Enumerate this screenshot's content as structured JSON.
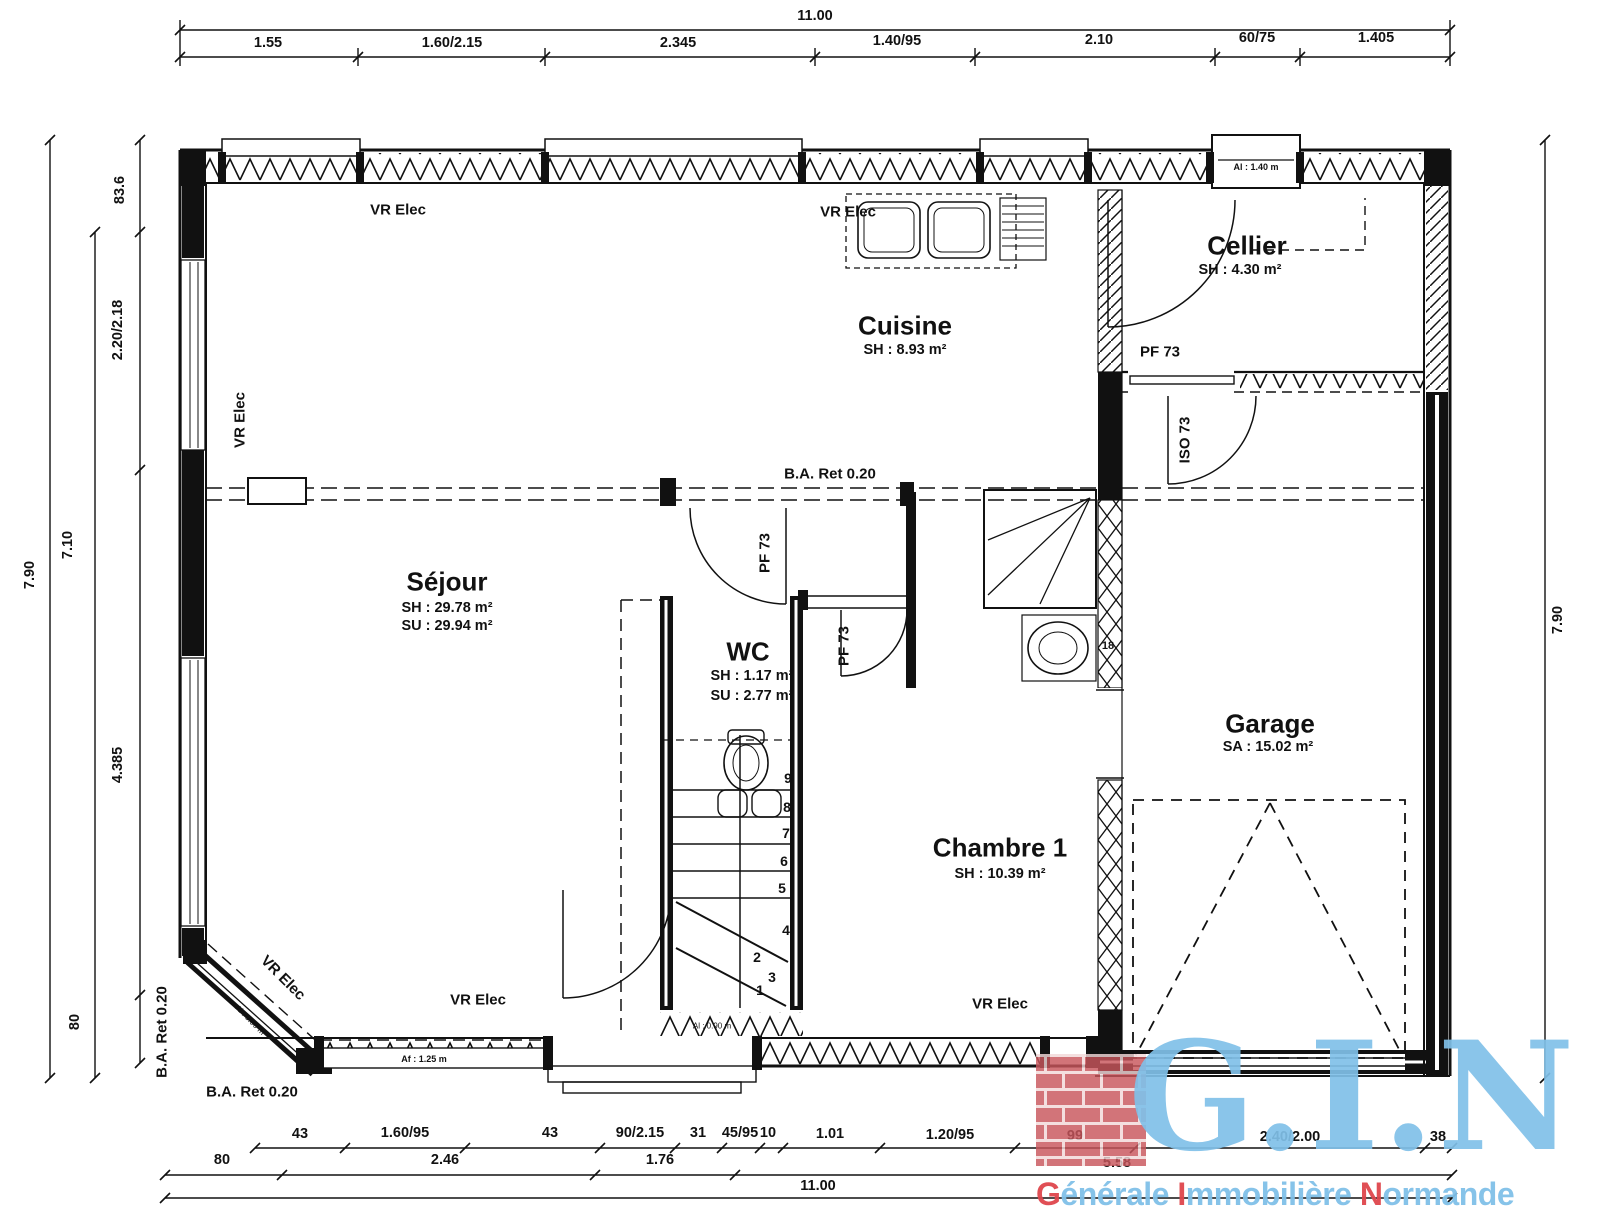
{
  "logo": {
    "acronym": "G.I.N",
    "words": [
      {
        "lead": "G",
        "rest": "énérale"
      },
      {
        "lead": "I",
        "rest": "mmobilière"
      },
      {
        "lead": "N",
        "rest": "ormande"
      }
    ],
    "brand_blue": "#80c0e8",
    "brand_red": "#de464c"
  },
  "rooms": {
    "sejour": {
      "name": "Séjour",
      "l1": "SH : 29.78 m²",
      "l2": "SU : 29.94 m²"
    },
    "cuisine": {
      "name": "Cuisine",
      "l1": "SH : 8.93 m²"
    },
    "cellier": {
      "name": "Cellier",
      "l1": "SH : 4.30 m²"
    },
    "wc": {
      "name": "WC",
      "l1": "SH : 1.17 m²",
      "l2": "SU : 2.77 m²"
    },
    "chambre1": {
      "name": "Chambre 1",
      "l1": "SH : 10.39 m²"
    },
    "garage": {
      "name": "Garage",
      "l1": "SA : 15.02 m²"
    }
  },
  "dims": {
    "top": {
      "overall": "11.00",
      "s": [
        "1.55",
        "1.60/2.15",
        "2.345",
        "1.40/95",
        "2.10",
        "60/75",
        "1.405"
      ]
    },
    "left": {
      "overall": "7.90",
      "inner": "7.10",
      "s": [
        "83.6",
        "2.20/2.18",
        "4.385",
        "80"
      ]
    },
    "right": {
      "overall": "7.90"
    },
    "bottom": {
      "r1": [
        "43",
        "1.60/95",
        "43",
        "90/2.15",
        "31",
        "45/95",
        "10",
        "1.01",
        "1.20/95",
        "99",
        "2.40/2.00",
        "38"
      ],
      "r2": [
        "80",
        "2.46",
        "1.76",
        "5.58"
      ],
      "overall": "11.00"
    }
  },
  "ann": {
    "vr": "VR Elec",
    "ba": "B.A. Ret 0.20",
    "pf": "PF 73",
    "iso": "ISO 73",
    "al140": "Al : 1.40 m",
    "af125": "Af : 1.25 m",
    "al090": "Al : 0.90 m",
    "n18": "18"
  },
  "stairs": [
    "1",
    "2",
    "3",
    "4",
    "5",
    "6",
    "7",
    "8",
    "9"
  ]
}
